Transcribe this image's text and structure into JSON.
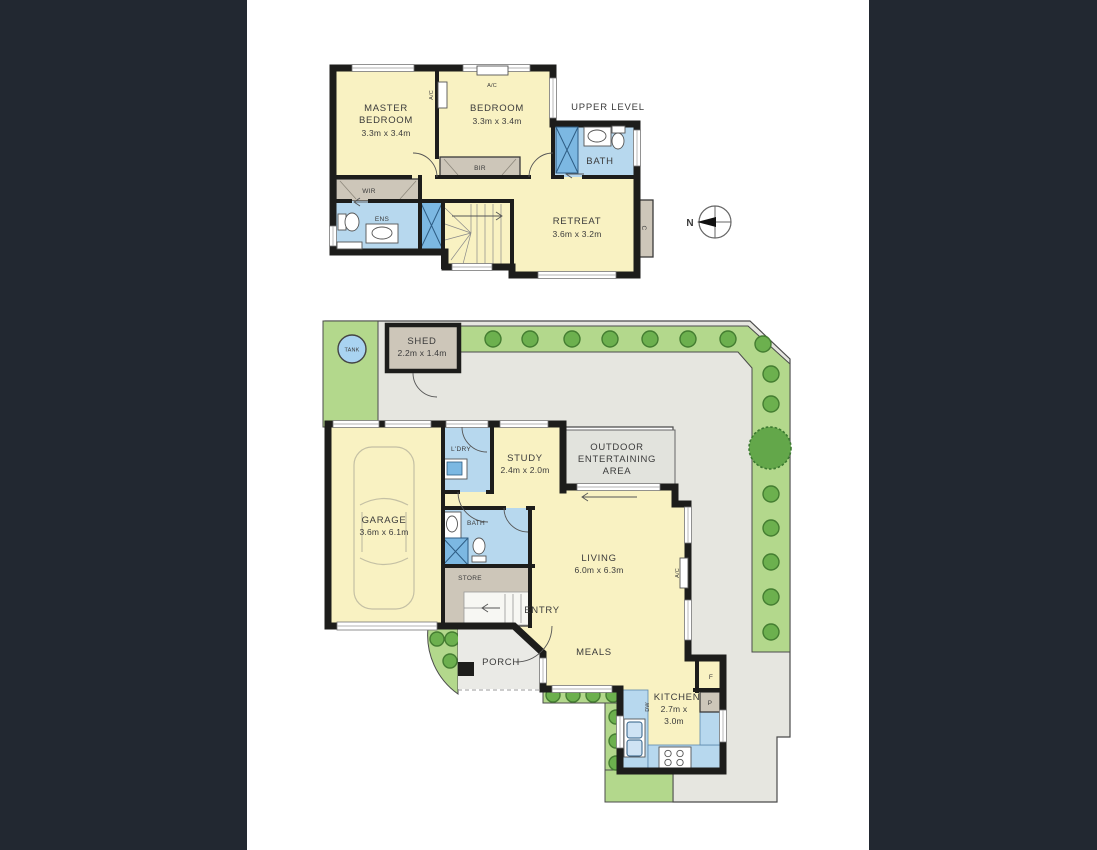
{
  "page": {
    "background_color": "#222831",
    "panel_color": "#ffffff"
  },
  "colors": {
    "background": "#222831",
    "panel": "#ffffff",
    "wall": "#1d1d1b",
    "room_yellow": "#f9f2c2",
    "wet_blue": "#b7d8ee",
    "fixture_blue": "#7cb8e2",
    "robe_grey": "#cdc6b9",
    "paving_grey": "#e6e6e0",
    "outdoor_grey": "#e2e3dd",
    "porch_grey": "#eaeae6",
    "garden_green": "#b3d88c",
    "shrub_green": "#6cb04e",
    "shrub_stroke": "#447d31",
    "tree_green": "#63a74a",
    "tank_blue": "#a9d3f1",
    "label": "#3b3b3b"
  },
  "compass": {
    "north_label": "N"
  },
  "upper_level": {
    "title": "UPPER LEVEL",
    "master_bedroom": {
      "line1": "MASTER",
      "line2": "BEDROOM",
      "dims": "3.3m x 3.4m"
    },
    "bedroom": {
      "name": "BEDROOM",
      "dims": "3.3m x 3.4m"
    },
    "bath": {
      "name": "BATH"
    },
    "retreat": {
      "name": "RETREAT",
      "dims": "3.6m x 3.2m"
    },
    "wir": {
      "name": "WIR"
    },
    "ens": {
      "name": "ENS"
    },
    "bir": {
      "name": "BIR"
    },
    "closet": {
      "name": "C"
    },
    "ac_wall": {
      "name": "A/C"
    },
    "ac_unit": {
      "name": "A/C"
    }
  },
  "ground_level": {
    "shed": {
      "name": "SHED",
      "dims": "2.2m x 1.4m"
    },
    "tank": {
      "name": "TANK"
    },
    "garage": {
      "name": "GARAGE",
      "dims": "3.6m x 6.1m"
    },
    "laundry": {
      "name": "L'DRY"
    },
    "study": {
      "name": "STUDY",
      "dims": "2.4m x 2.0m"
    },
    "outdoor": {
      "line1": "OUTDOOR",
      "line2": "ENTERTAINING",
      "line3": "AREA"
    },
    "bath": {
      "name": "BATH"
    },
    "store": {
      "name": "STORE"
    },
    "entry": {
      "name": "ENTRY"
    },
    "living": {
      "name": "LIVING",
      "dims": "6.0m x 6.3m"
    },
    "meals": {
      "name": "MEALS"
    },
    "porch": {
      "name": "PORCH"
    },
    "kitchen": {
      "name": "KITCHEN",
      "dims_line1": "2.7m x",
      "dims_line2": "3.0m"
    },
    "fridge": {
      "name": "F"
    },
    "pantry": {
      "name": "P"
    },
    "dishwasher": {
      "name": "DW"
    },
    "ac": {
      "name": "A/C"
    }
  }
}
